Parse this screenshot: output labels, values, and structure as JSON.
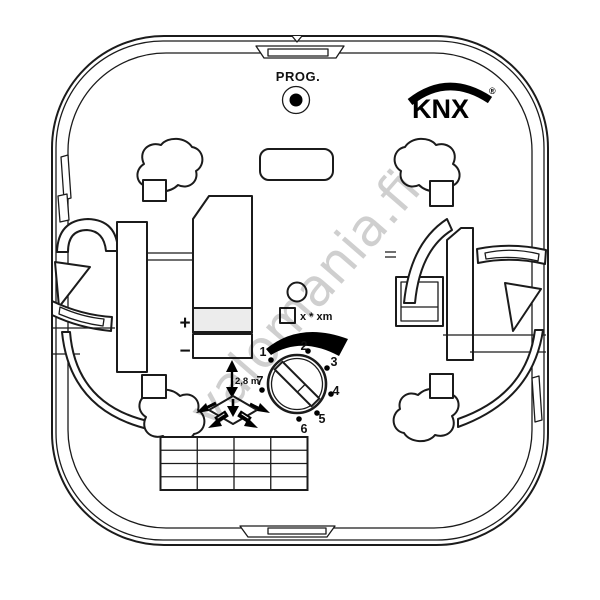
{
  "device": {
    "prog": {
      "label": "PROG."
    },
    "brand": {
      "name": "KNX",
      "registered": "®"
    },
    "bus_terminal": {
      "plus": "+",
      "minus": "−"
    },
    "settings": {
      "mounting_height": "2,8 m",
      "area_formula": "x * xm",
      "dial_positions": [
        "1",
        "2",
        "3",
        "4",
        "5",
        "6",
        "7"
      ]
    }
  },
  "watermark": {
    "text": "valomania.fi"
  },
  "icons": {
    "prog_button": "filled-dot-in-circle",
    "status_led": "circle-outline",
    "dial_slot": "screw-slot",
    "height_indicator": "double-headed-arrow",
    "detection_area": "diamond-with-arrows",
    "range_arc": "black-crescent"
  },
  "colors": {
    "line": "#1b1b1b",
    "background": "#ffffff",
    "watermark": "#c1c1c1",
    "terminal_band_fill": "#ececec",
    "accent": "#000000"
  }
}
